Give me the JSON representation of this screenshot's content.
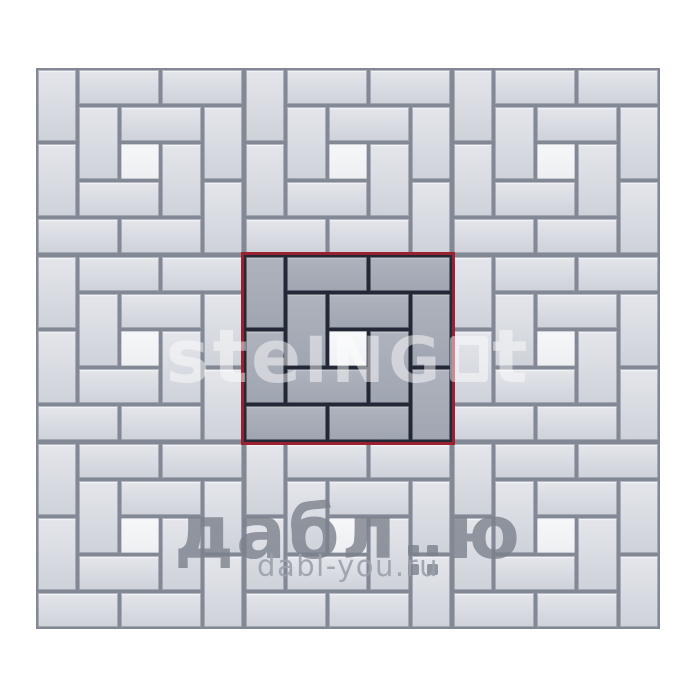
{
  "title": "Paving stone laying pattern with highlighted repeating module",
  "colors": {
    "page_bg": "#ffffff",
    "light_gap": "#828894",
    "light_brick_top": "#e4e6eb",
    "light_brick_bottom": "#ced2d9",
    "light_square_top": "#f6f7f9",
    "light_square_bottom": "#edeff2",
    "dark_gap": "#222835",
    "dark_brick_top": "#aeb3bd",
    "dark_brick_bottom": "#a0a6b1",
    "dark_square_top": "#f8f9fb",
    "dark_square_bottom": "#eff1f4",
    "highlight_outline": "#9b2130",
    "wm_brand": "#7c828c",
    "wm_url": "#9aa1ab"
  },
  "pavement": {
    "origin_x": 36,
    "origin_y": 68,
    "modules_cols": 3,
    "modules_rows": 3,
    "module_width": 208,
    "module_height": 187,
    "cells_per_module": 5,
    "gap_inset": 1.5,
    "highlighted_module": {
      "col": 1,
      "row": 1
    },
    "pieces": [
      {
        "col": 0,
        "row": 0,
        "w": 1,
        "h": 2,
        "kind": "brick"
      },
      {
        "col": 1,
        "row": 0,
        "w": 2,
        "h": 1,
        "kind": "brick"
      },
      {
        "col": 3,
        "row": 0,
        "w": 2,
        "h": 1,
        "kind": "brick"
      },
      {
        "col": 1,
        "row": 1,
        "w": 1,
        "h": 2,
        "kind": "brick"
      },
      {
        "col": 2,
        "row": 1,
        "w": 2,
        "h": 1,
        "kind": "brick"
      },
      {
        "col": 4,
        "row": 1,
        "w": 1,
        "h": 2,
        "kind": "brick"
      },
      {
        "col": 0,
        "row": 2,
        "w": 1,
        "h": 2,
        "kind": "brick"
      },
      {
        "col": 2,
        "row": 2,
        "w": 1,
        "h": 1,
        "kind": "square"
      },
      {
        "col": 3,
        "row": 2,
        "w": 1,
        "h": 2,
        "kind": "brick"
      },
      {
        "col": 1,
        "row": 3,
        "w": 2,
        "h": 1,
        "kind": "brick"
      },
      {
        "col": 4,
        "row": 3,
        "w": 1,
        "h": 2,
        "kind": "brick"
      },
      {
        "col": 0,
        "row": 4,
        "w": 2,
        "h": 1,
        "kind": "brick"
      },
      {
        "col": 2,
        "row": 4,
        "w": 2,
        "h": 1,
        "kind": "brick"
      }
    ]
  },
  "watermarks": {
    "center_logo": {
      "part1": "ste",
      "part2": "ING",
      "part3": "t"
    },
    "bottom_brand": {
      "part1": "дабл",
      "part2": "ю"
    },
    "bottom_url": "dabl-you.ru"
  }
}
